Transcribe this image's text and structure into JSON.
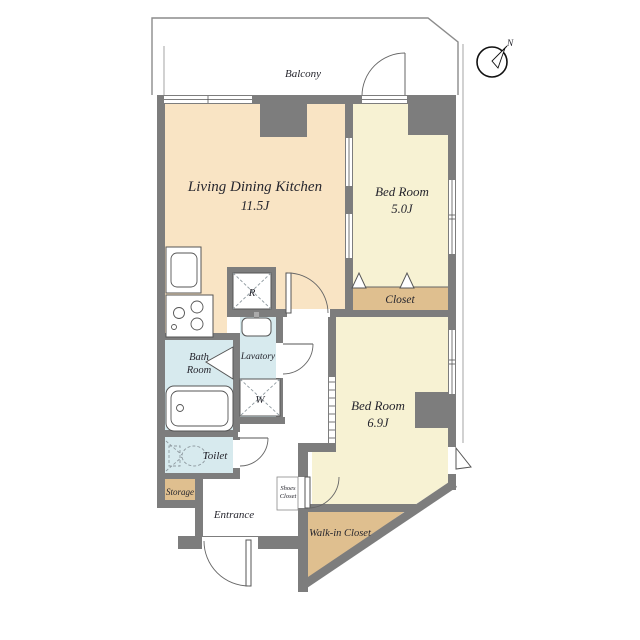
{
  "colors": {
    "ldk": "#F9E4C4",
    "bedroom": "#F7F2D3",
    "closet": "#DFBF8F",
    "water": "#D7EAEE",
    "wall": "#7D7D7D"
  },
  "balcony": {
    "label": "Balcony"
  },
  "compass": {
    "label": "N"
  },
  "rooms": {
    "ldk": {
      "name": "Living Dining Kitchen",
      "size": "11.5J"
    },
    "bedroom5": {
      "name": "Bed Room",
      "size": "5.0J"
    },
    "bedroom6": {
      "name": "Bed Room",
      "size": "6.9J"
    },
    "closet": {
      "label": "Closet"
    },
    "walk_in_closet": {
      "label": "Walk-in Closet"
    },
    "shoes_closet": {
      "line1": "Shoes",
      "line2": "Closet"
    },
    "entrance": {
      "label": "Entrance"
    },
    "storage": {
      "label": "Storage"
    },
    "toilet": {
      "label": "Toilet"
    },
    "bath_room": {
      "line1": "Bath",
      "line2": "Room"
    },
    "lavatory": {
      "label": "Lavatory"
    },
    "refrigerator_space": {
      "label": "R"
    },
    "washer_space": {
      "label": "W"
    }
  }
}
